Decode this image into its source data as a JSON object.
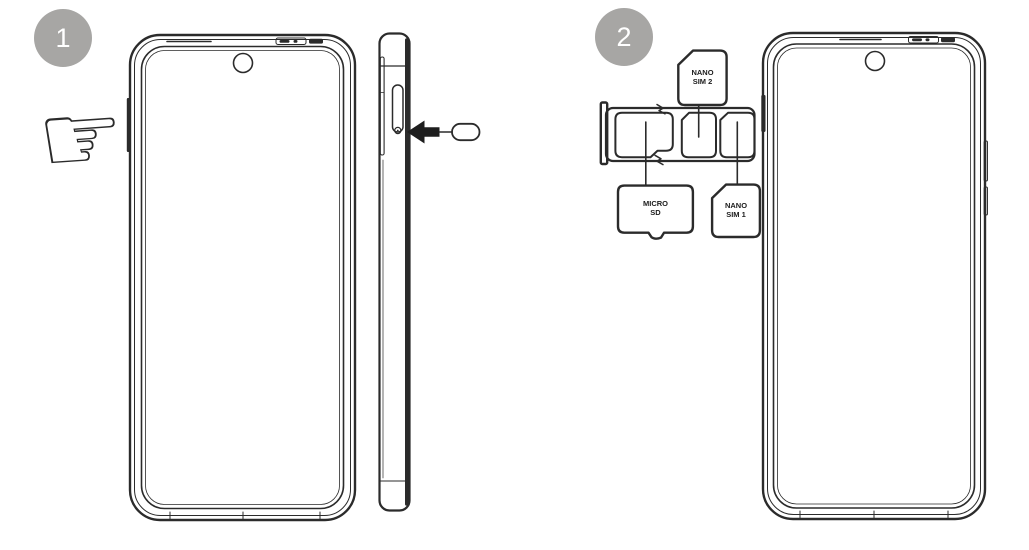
{
  "canvas": {
    "background": "#ffffff",
    "line_color": "#2b2b2b",
    "badge_color": "#a7a6a4"
  },
  "step1": {
    "number": "1",
    "hand_glyph": "☞"
  },
  "step2": {
    "number": "2",
    "cards": {
      "nano_sim_2": "NANO\nSIM 2",
      "micro_sd": "MICRO\nSD",
      "nano_sim_1": "NANO\nSIM 1"
    }
  }
}
